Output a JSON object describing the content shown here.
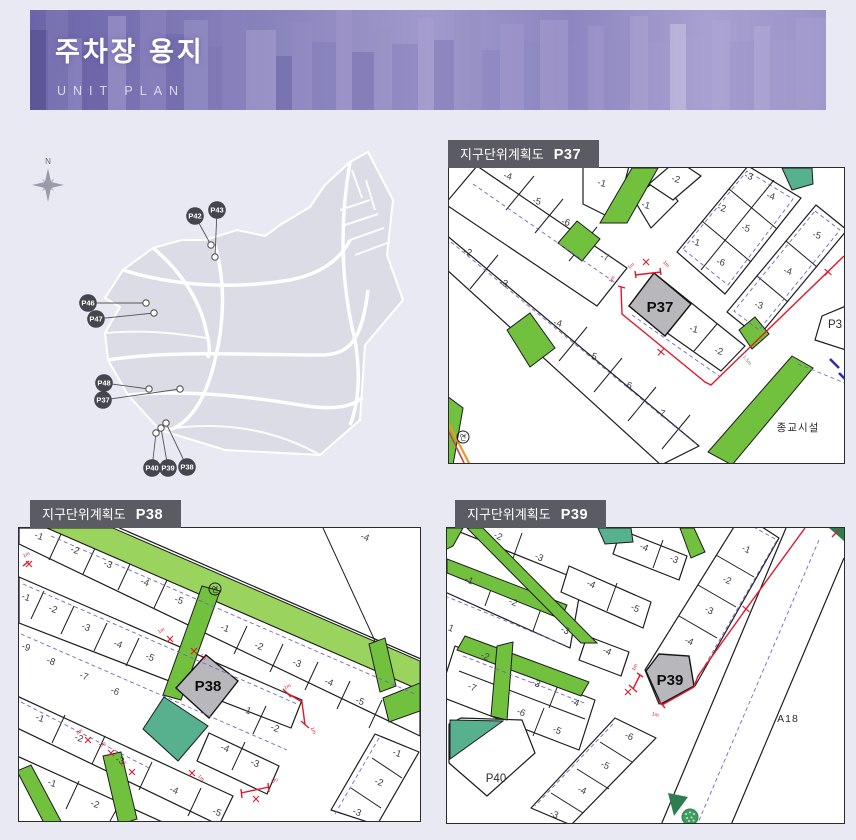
{
  "header": {
    "title": "주차장 용지",
    "subtitle": "UNIT PLAN"
  },
  "colors": {
    "page_bg": "#e9e9f4",
    "banner_purple": "#8a83bf",
    "label_bar_gray": "#5b5b63",
    "parcel_green": "#72c13e",
    "park_band_green": "#9bd35f",
    "teal_green": "#58b18e",
    "highlight_gray": "#b8b8bc",
    "annotation_red": "#e0182c",
    "marker_dark": "#45454e"
  },
  "overview": {
    "compass_label": "N",
    "markers": [
      {
        "label": "P42",
        "x": 185,
        "y": 76,
        "dotX": 201,
        "dotY": 105
      },
      {
        "label": "P43",
        "x": 207,
        "y": 70,
        "dotX": 205,
        "dotY": 117
      },
      {
        "label": "P46",
        "x": 78,
        "y": 163,
        "dotX": 136,
        "dotY": 163
      },
      {
        "label": "P47",
        "x": 86,
        "y": 179,
        "dotX": 144,
        "dotY": 173
      },
      {
        "label": "P48",
        "x": 94,
        "y": 243,
        "dotX": 139,
        "dotY": 249
      },
      {
        "label": "P37",
        "x": 93,
        "y": 260,
        "dotX": 170,
        "dotY": 249
      },
      {
        "label": "P40",
        "x": 142,
        "y": 328,
        "dotX": 146,
        "dotY": 293
      },
      {
        "label": "P39",
        "x": 158,
        "y": 328,
        "dotX": 151,
        "dotY": 288
      },
      {
        "label": "P38",
        "x": 177,
        "y": 327,
        "dotX": 156,
        "dotY": 283
      }
    ]
  },
  "panels": [
    {
      "id": "p37",
      "title": "지구단위계획도",
      "code": "P37",
      "lots": [
        {
          "label": "-4",
          "x": 58,
          "y": 11,
          "rot": 15
        },
        {
          "label": "-5",
          "x": 87,
          "y": 36,
          "rot": 15
        },
        {
          "label": "-6",
          "x": 116,
          "y": 57,
          "rot": 15
        },
        {
          "label": "-7",
          "x": 155,
          "y": 92,
          "rot": 15
        },
        {
          "label": "-2",
          "x": 18,
          "y": 87,
          "rot": 15
        },
        {
          "label": "-3",
          "x": 54,
          "y": 118,
          "rot": 15
        },
        {
          "label": "-4",
          "x": 108,
          "y": 158,
          "rot": 15
        },
        {
          "label": "-5",
          "x": 143,
          "y": 191,
          "rot": 15
        },
        {
          "label": "-6",
          "x": 178,
          "y": 220,
          "rot": 15
        },
        {
          "label": "-7",
          "x": 211,
          "y": 248,
          "rot": 15
        },
        {
          "label": "-1",
          "x": 152,
          "y": 18,
          "rot": 15
        },
        {
          "label": "-1",
          "x": 196,
          "y": 40,
          "rot": 15
        },
        {
          "label": "-2",
          "x": 226,
          "y": 14,
          "rot": 15
        },
        {
          "label": "-3",
          "x": 299,
          "y": 11,
          "rot": 15
        },
        {
          "label": "-2",
          "x": 272,
          "y": 43,
          "rot": 15
        },
        {
          "label": "-1",
          "x": 246,
          "y": 77,
          "rot": 15
        },
        {
          "label": "-4",
          "x": 321,
          "y": 31,
          "rot": 15
        },
        {
          "label": "-5",
          "x": 296,
          "y": 63,
          "rot": 15
        },
        {
          "label": "-6",
          "x": 271,
          "y": 97,
          "rot": 15
        },
        {
          "label": "-5",
          "x": 367,
          "y": 70,
          "rot": 15
        },
        {
          "label": "-4",
          "x": 338,
          "y": 106,
          "rot": 15
        },
        {
          "label": "-3",
          "x": 309,
          "y": 140,
          "rot": 15
        },
        {
          "label": "-1",
          "x": 244,
          "y": 164,
          "rot": 15
        },
        {
          "label": "-2",
          "x": 269,
          "y": 186,
          "rot": 15
        },
        {
          "label": "P37",
          "x": 211,
          "y": 144,
          "cls": "big"
        },
        {
          "label": "P3",
          "x": 386,
          "y": 160,
          "cls": "med"
        },
        {
          "label": "종교시설",
          "x": 349,
          "y": 263,
          "cls": "place"
        },
        {
          "label": "연",
          "x": 14,
          "y": 271.5,
          "cls": "yeon"
        }
      ],
      "annotations": [
        {
          "t": "text",
          "label": "1m",
          "x": 183,
          "y": 99,
          "rot": -40
        },
        {
          "t": "x",
          "x": 197,
          "y": 94
        },
        {
          "t": "text",
          "label": "1m",
          "x": 216,
          "y": 97,
          "rot": 50
        },
        {
          "t": "text",
          "label": "1m",
          "x": 164,
          "y": 112,
          "rot": -55
        },
        {
          "t": "plus",
          "x": 212,
          "y": 184,
          "rot": 40
        },
        {
          "t": "plus",
          "x": 379,
          "y": 104,
          "rot": 40
        },
        {
          "t": "text",
          "label": "1.5m",
          "x": 297,
          "y": 193,
          "rot": 52,
          "cls": "dim"
        }
      ]
    },
    {
      "id": "p38",
      "title": "지구단위계획도",
      "code": "P38",
      "lots": [
        {
          "label": "-1",
          "x": 19,
          "y": 11,
          "rot": 20
        },
        {
          "label": "-2",
          "x": 55,
          "y": 25,
          "rot": 20
        },
        {
          "label": "-3",
          "x": 88,
          "y": 39,
          "rot": 20
        },
        {
          "label": "-4",
          "x": 125,
          "y": 57,
          "rot": 20
        },
        {
          "label": "-5",
          "x": 159,
          "y": 75,
          "rot": 20
        },
        {
          "label": "-4",
          "x": 345,
          "y": 12,
          "rot": 20
        },
        {
          "label": "-1",
          "x": 205,
          "y": 103,
          "rot": 20
        },
        {
          "label": "-2",
          "x": 239,
          "y": 121,
          "rot": 20
        },
        {
          "label": "-3",
          "x": 277,
          "y": 138,
          "rot": 20
        },
        {
          "label": "-4",
          "x": 309,
          "y": 157,
          "rot": 20
        },
        {
          "label": "-5",
          "x": 340,
          "y": 176,
          "rot": 20
        },
        {
          "label": "-1",
          "x": 6,
          "y": 72,
          "rot": 20
        },
        {
          "label": "-2",
          "x": 33,
          "y": 84,
          "rot": 20
        },
        {
          "label": "-3",
          "x": 66,
          "y": 102,
          "rot": 20
        },
        {
          "label": "-4",
          "x": 98,
          "y": 119,
          "rot": 20
        },
        {
          "label": "-5",
          "x": 130,
          "y": 132,
          "rot": 20
        },
        {
          "label": "-9",
          "x": 6,
          "y": 122,
          "rot": 20
        },
        {
          "label": "-8",
          "x": 31,
          "y": 136,
          "rot": 20
        },
        {
          "label": "-7",
          "x": 64,
          "y": 151,
          "rot": 20
        },
        {
          "label": "-6",
          "x": 95,
          "y": 166,
          "rot": 20
        },
        {
          "label": "-1",
          "x": 227,
          "y": 185,
          "rot": 20
        },
        {
          "label": "-2",
          "x": 255,
          "y": 203,
          "rot": 20
        },
        {
          "label": "-4",
          "x": 205,
          "y": 223,
          "rot": 20
        },
        {
          "label": "-3",
          "x": 235,
          "y": 238,
          "rot": 20
        },
        {
          "label": "-1",
          "x": 377,
          "y": 228,
          "rot": 20
        },
        {
          "label": "-2",
          "x": 359,
          "y": 257,
          "rot": 20
        },
        {
          "label": "-3",
          "x": 337,
          "y": 287,
          "rot": 20
        },
        {
          "label": "-1",
          "x": 20,
          "y": 193,
          "rot": 20
        },
        {
          "label": "-2",
          "x": 59,
          "y": 213,
          "rot": 20
        },
        {
          "label": "-3",
          "x": 100,
          "y": 235,
          "rot": 20
        },
        {
          "label": "-4",
          "x": 154,
          "y": 265,
          "rot": 20
        },
        {
          "label": "-5",
          "x": 197,
          "y": 287,
          "rot": 20
        },
        {
          "label": "-1",
          "x": 32,
          "y": 258,
          "rot": 20
        },
        {
          "label": "-2",
          "x": 75,
          "y": 279,
          "rot": 20
        },
        {
          "label": "P38",
          "x": 189,
          "y": 163,
          "cls": "big"
        },
        {
          "label": "연",
          "x": 196,
          "y": 63.5,
          "cls": "yeon"
        }
      ],
      "annotations": [
        {
          "t": "text",
          "label": "1m",
          "x": 8,
          "y": 28,
          "rot": -25
        },
        {
          "t": "x",
          "x": 10,
          "y": 36
        },
        {
          "t": "x",
          "x": 151,
          "y": 111
        },
        {
          "t": "text",
          "label": "1m",
          "x": 143,
          "y": 104,
          "rot": -30
        },
        {
          "t": "x",
          "x": 175,
          "y": 123
        },
        {
          "t": "text",
          "label": "1m",
          "x": 183,
          "y": 130,
          "rot": 45
        },
        {
          "t": "x",
          "x": 69,
          "y": 212
        },
        {
          "t": "text",
          "label": "1m",
          "x": 61,
          "y": 205,
          "rot": -30
        },
        {
          "t": "x",
          "x": 92,
          "y": 225
        },
        {
          "t": "text",
          "label": "1m",
          "x": 84,
          "y": 218,
          "rot": -30
        },
        {
          "t": "x",
          "x": 113,
          "y": 244
        },
        {
          "t": "text",
          "label": "1m",
          "x": 105,
          "y": 237,
          "rot": -30
        },
        {
          "t": "x",
          "x": 173,
          "y": 245
        },
        {
          "t": "text",
          "label": "1m",
          "x": 181,
          "y": 251,
          "rot": 45
        },
        {
          "t": "text",
          "label": "1m",
          "x": 269,
          "y": 160,
          "rot": -25
        },
        {
          "t": "text",
          "label": "1m",
          "x": 293,
          "y": 203,
          "rot": 70
        },
        {
          "t": "x",
          "x": 237,
          "y": 271
        },
        {
          "t": "text",
          "label": "1m",
          "x": 256,
          "y": 254,
          "rot": -20
        }
      ]
    },
    {
      "id": "p39",
      "title": "지구단위계획도",
      "code": "P39",
      "lots": [
        {
          "label": "-2",
          "x": 50,
          "y": 11,
          "rot": 22
        },
        {
          "label": "-3",
          "x": 91,
          "y": 32,
          "rot": 22
        },
        {
          "label": "-1",
          "x": 21,
          "y": 55,
          "rot": 22
        },
        {
          "label": "-2",
          "x": 65,
          "y": 77,
          "rot": 22
        },
        {
          "label": "-3",
          "x": 117,
          "y": 105,
          "rot": 22
        },
        {
          "label": "-4",
          "x": 143,
          "y": 59,
          "rot": 22
        },
        {
          "label": "-5",
          "x": 187,
          "y": 83,
          "rot": 22
        },
        {
          "label": "-4",
          "x": 196,
          "y": 22,
          "rot": 22
        },
        {
          "label": "-3",
          "x": 226,
          "y": 34,
          "rot": 22
        },
        {
          "label": "-1",
          "x": 298,
          "y": 24,
          "rot": 22
        },
        {
          "label": "-2",
          "x": 279,
          "y": 55,
          "rot": 22
        },
        {
          "label": "-3",
          "x": 261,
          "y": 85,
          "rot": 22
        },
        {
          "label": "-4",
          "x": 241,
          "y": 116,
          "rot": 22
        },
        {
          "label": "-4",
          "x": 159,
          "y": 126,
          "rot": 22
        },
        {
          "label": "-2",
          "x": 37,
          "y": 131,
          "rot": 22
        },
        {
          "label": "-3",
          "x": 88,
          "y": 158,
          "rot": 22
        },
        {
          "label": "-4",
          "x": 127,
          "y": 177,
          "rot": 22
        },
        {
          "label": "-7",
          "x": 24,
          "y": 162,
          "rot": 22
        },
        {
          "label": "-6",
          "x": 73,
          "y": 187,
          "rot": 22
        },
        {
          "label": "-5",
          "x": 109,
          "y": 205,
          "rot": 22
        },
        {
          "label": "-6",
          "x": 181,
          "y": 211,
          "rot": 22
        },
        {
          "label": "-5",
          "x": 157,
          "y": 240,
          "rot": 22
        },
        {
          "label": "-4",
          "x": 134,
          "y": 265,
          "rot": 22
        },
        {
          "label": "-3",
          "x": 106,
          "y": 289,
          "rot": 22
        },
        {
          "label": "1",
          "x": 3,
          "y": 103,
          "rot": 22
        },
        {
          "label": "P40",
          "x": 49,
          "y": 254,
          "cls": "med"
        },
        {
          "label": "P39",
          "x": 223,
          "y": 157,
          "cls": "big"
        },
        {
          "label": "A18",
          "x": 341,
          "y": 194,
          "cls": "place"
        }
      ],
      "annotations": [
        {
          "t": "plus",
          "x": 299,
          "y": 81,
          "rot": 40
        },
        {
          "t": "x",
          "x": 181,
          "y": 164
        },
        {
          "t": "text",
          "label": "1m",
          "x": 189,
          "y": 140,
          "rot": -65
        },
        {
          "t": "text",
          "label": "1m",
          "x": 208,
          "y": 188,
          "rot": 15
        }
      ]
    }
  ]
}
